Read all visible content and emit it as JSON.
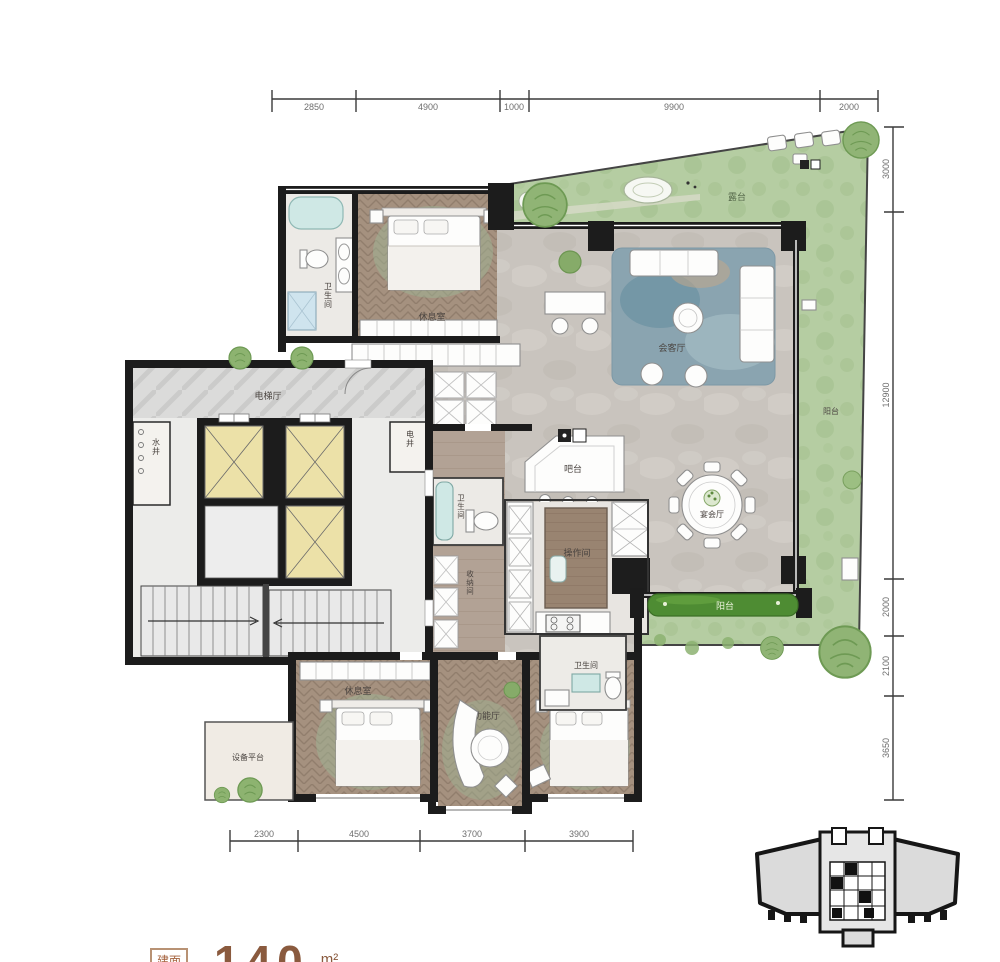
{
  "dimensions": {
    "top": [
      "2850",
      "4900",
      "1000",
      "9900",
      "2000"
    ],
    "right": [
      "3000",
      "12900",
      "2000",
      "2100",
      "3650"
    ],
    "bottom": [
      "2300",
      "4500",
      "3700",
      "3900"
    ]
  },
  "rooms": {
    "bath_top": "卫生间",
    "bedroom_top": "休息室",
    "living": "会客厅",
    "terrace": "露台",
    "balcony_right": "阳台",
    "balcony_bottom": "阳台",
    "elevator_hall": "电梯厅",
    "water_shaft": "水井",
    "electric_shaft": "电井",
    "bar": "吧台",
    "banquet": "宴会厅",
    "kitchen": "操作间",
    "wc_corridor": "卫生间",
    "storage": "收纳间",
    "bath_bottom": "卫生间",
    "bedroom_bottom_left": "休息室",
    "multi_function": "多功能厅",
    "bedroom_bottom_right": "休息室",
    "equipment_platform": "设备平台"
  },
  "area_label": {
    "prefix": "建面",
    "value": "140",
    "unit": "m²"
  },
  "colors": {
    "wall": "#1c1c1c",
    "terrace_green": "#b5cda2",
    "planter_green": "#4e8c33",
    "wood": "#a5917f",
    "marble": "#c9c4be",
    "rug_blue": "#8aa4b0",
    "elevator_yellow": "#ece1a8",
    "dim_text": "#6e6e6e",
    "label_text": "#4a4440",
    "area_text": "#8a5a3e"
  }
}
